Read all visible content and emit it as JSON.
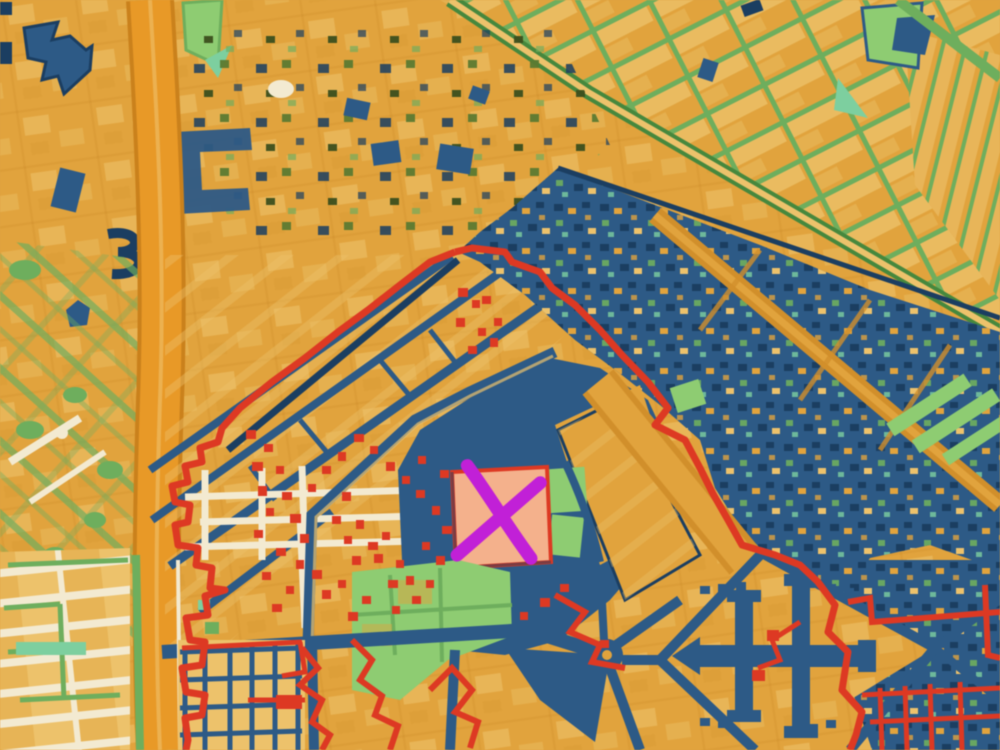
{
  "map": {
    "kind": "zoning-land-use-map",
    "marker": {
      "glyph": "X",
      "transform": "translate(500,514) rotate(4)",
      "color": "#be21d3"
    },
    "highlighted_parcel": {
      "fill": "#f2b18d",
      "outline": "#d93a25"
    },
    "regions": [
      {
        "id": "agricultural-fields-northeast",
        "fill": "#dfa340",
        "grid": "#6fad5f"
      },
      {
        "id": "dense-urban-band",
        "fill": "#2e5a85"
      },
      {
        "id": "central-district",
        "outline": "#d93a25",
        "fill": "#dfa340"
      },
      {
        "id": "village-building-cluster",
        "building_color": "#d93a25"
      },
      {
        "id": "selected-parcel",
        "fill": "#f2b18d"
      },
      {
        "id": "main-road-west",
        "fill": "#e6992b"
      },
      {
        "id": "south-ring-road",
        "fill": "#2e5a85"
      },
      {
        "id": "southeast-diamond-block",
        "fill": "#dfa340"
      }
    ]
  },
  "colors": {
    "tan": "#dfa340",
    "tanLight": "#ecc26e",
    "tanDeep": "#cf8f2e",
    "cream": "#f3ead2",
    "roadOrange": "#e6992b",
    "roadOrangeEdge": "#c8811f",
    "navy": "#2e5a85",
    "navyDark": "#1c3e60",
    "green": "#6fad5f",
    "greenDark": "#47873f",
    "greenLight": "#8fcb74",
    "mint": "#7fcea0",
    "red": "#d93a25",
    "pink": "#f2b18d",
    "magenta": "#be21d3",
    "olive": "#5c7a33",
    "oliveDark": "#3c4f1e"
  }
}
